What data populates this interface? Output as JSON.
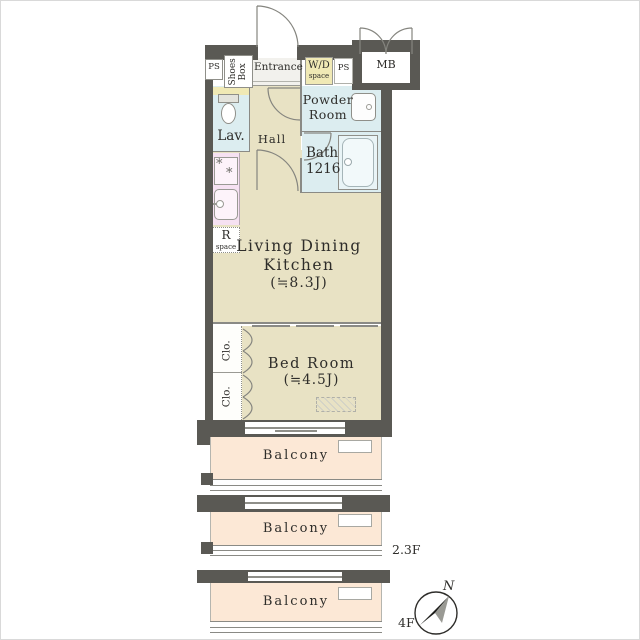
{
  "plan": {
    "rooms": {
      "ps_left": "PS",
      "shoes_box": "Shoes\nBox",
      "entrance": "Entrance",
      "wd_space": {
        "line1": "W/D",
        "line2": "space"
      },
      "ps_right": "PS",
      "mb": "MB",
      "powder": {
        "line1": "Powder",
        "line2": "Room"
      },
      "bath": {
        "line1": "Bath",
        "line2": "1216"
      },
      "lav": "Lav.",
      "hall": "Hall",
      "r_space": {
        "line1": "R",
        "line2": "space"
      },
      "ldk": {
        "line1": "Living Dining",
        "line2": "Kitchen",
        "line3": "(≒8.3J)"
      },
      "closet_upper": "Clo.",
      "closet_lower": "Clo.",
      "bedroom": {
        "line1": "Bed Room",
        "line2": "(≒4.5J)"
      },
      "balcony1": "Balcony",
      "balcony2": "Balcony",
      "balcony3": "Balcony"
    },
    "annotations": {
      "level_23": "2.3F",
      "level_4": "4F",
      "north": "N"
    },
    "icons": {
      "burner": "*"
    },
    "colors": {
      "wall": "#5a5954",
      "floor": "#e8e2c4",
      "wet": "#dcedf0",
      "tub": "#e9f4f6",
      "kitchen": "#f6e1f2",
      "appliance": "#fdf3fa",
      "utility": "#f0e9b5",
      "balcony": "#fce8d6",
      "entrancefloor": "#f2f1ed",
      "line": "#8a8a85",
      "ink": "#2e2d2a"
    }
  }
}
